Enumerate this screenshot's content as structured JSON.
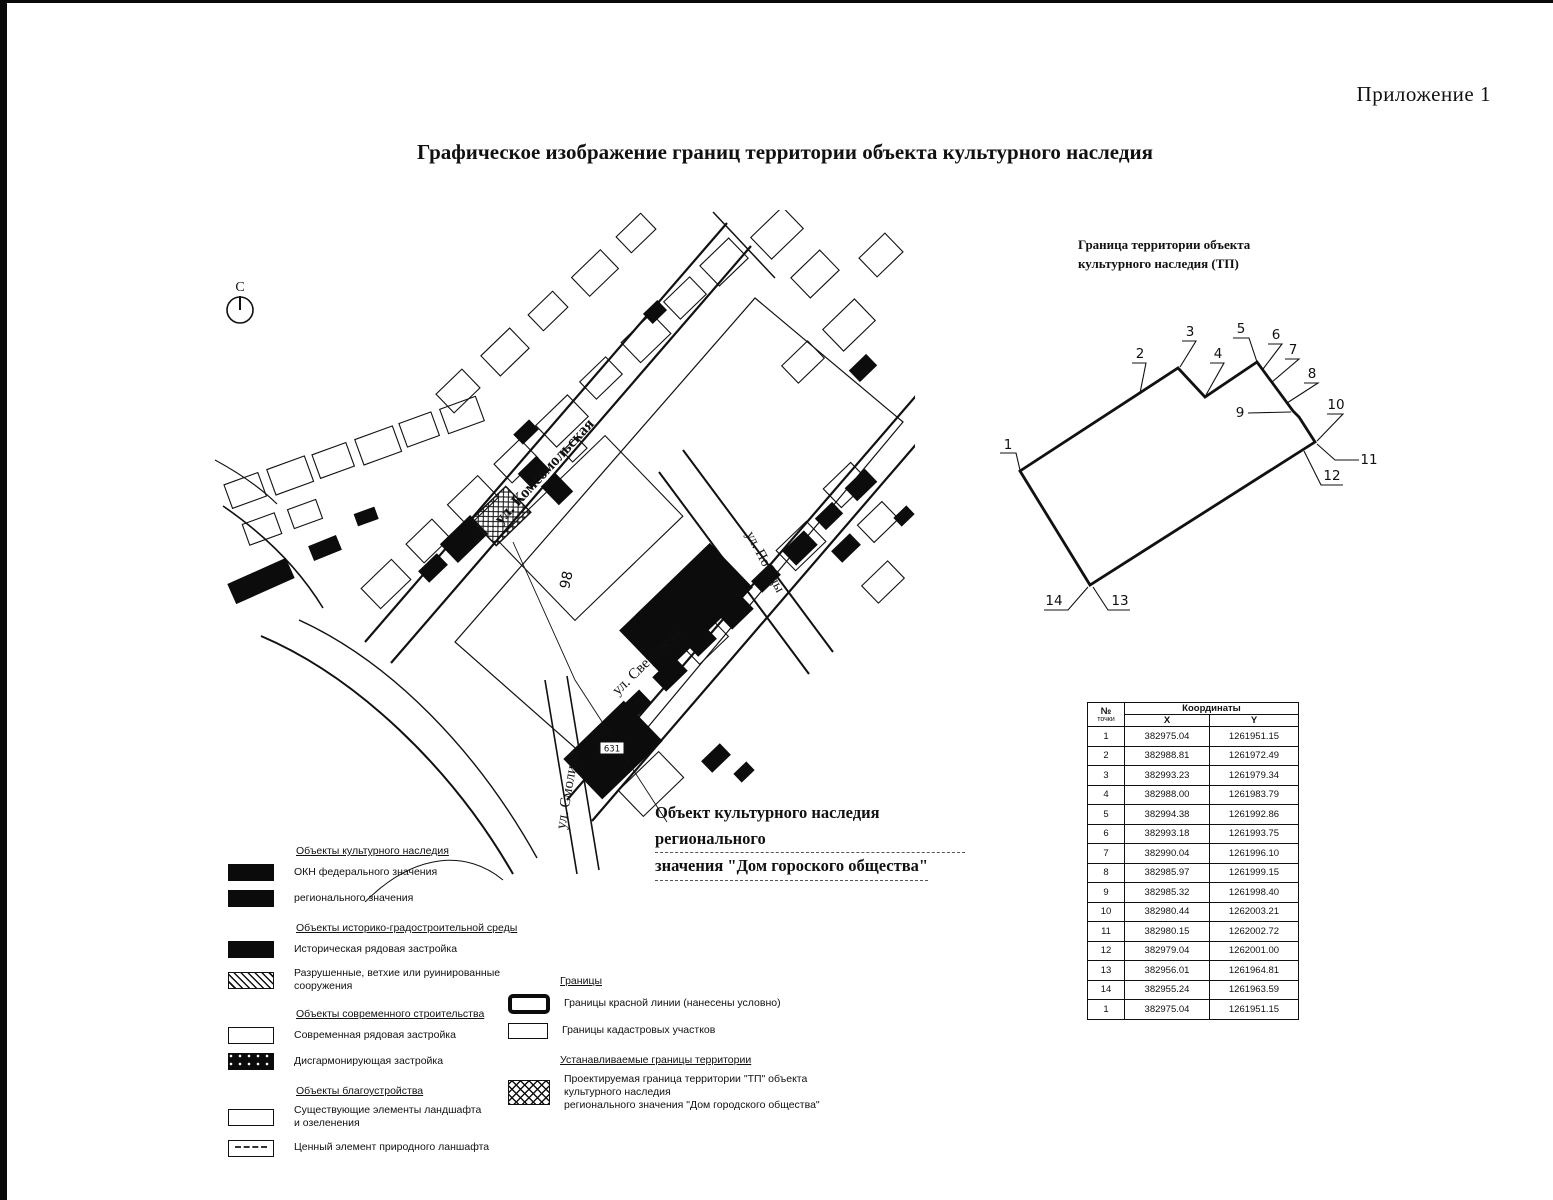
{
  "page": {
    "corner_label": "Приложение 1",
    "title": "Графическое изображение границ территории объекта культурного наследия"
  },
  "map": {
    "north_label": "С",
    "streets": {
      "komsomolskaya": "ул. Комсомольская",
      "sverdlova": "ул. Свердлова",
      "pobedy": "ул. Победы",
      "smolina": "ул. Смолина"
    },
    "building_labels": {
      "b98": "98",
      "b631": "631"
    },
    "annotation_line1": "Объект культурного наследия регионального",
    "annotation_line2": "значения \"Дом гороского общества\""
  },
  "boundary_diagram": {
    "title": "Граница территории объекта\nкультурного наследия (ТП)",
    "point_labels": [
      "1",
      "2",
      "3",
      "4",
      "5",
      "6",
      "7",
      "8",
      "9",
      "10",
      "11",
      "12",
      "13",
      "14"
    ]
  },
  "coords_table": {
    "col_point_no": "№",
    "col_point_sub": "точки",
    "col_coords": "Координаты",
    "col_x": "X",
    "col_y": "Y",
    "rows": [
      [
        "1",
        "382975.04",
        "1261951.15"
      ],
      [
        "2",
        "382988.81",
        "1261972.49"
      ],
      [
        "3",
        "382993.23",
        "1261979.34"
      ],
      [
        "4",
        "382988.00",
        "1261983.79"
      ],
      [
        "5",
        "382994.38",
        "1261992.86"
      ],
      [
        "6",
        "382993.18",
        "1261993.75"
      ],
      [
        "7",
        "382990.04",
        "1261996.10"
      ],
      [
        "8",
        "382985.97",
        "1261999.15"
      ],
      [
        "9",
        "382985.32",
        "1261998.40"
      ],
      [
        "10",
        "382980.44",
        "1262003.21"
      ],
      [
        "11",
        "382980.15",
        "1262002.72"
      ],
      [
        "12",
        "382979.04",
        "1262001.00"
      ],
      [
        "13",
        "382956.01",
        "1261964.81"
      ],
      [
        "14",
        "382955.24",
        "1261963.59"
      ],
      [
        "1",
        "382975.04",
        "1261951.15"
      ]
    ]
  },
  "legend": {
    "left": [
      {
        "header": "Объекты культурного наследия",
        "items": [
          {
            "label": "ОКН федерального значения"
          },
          {
            "label": "регионального значения"
          }
        ]
      },
      {
        "header": "Объекты историко-градостроительной среды",
        "items": [
          {
            "label": "Историческая рядовая застройка"
          },
          {
            "label": "Разрушенные, ветхие или руинированные сооружения"
          }
        ]
      },
      {
        "header": "Объекты современного строительства",
        "items": [
          {
            "label": "Современная рядовая застройка"
          },
          {
            "label": "Дисгармонирующая застройка"
          }
        ]
      },
      {
        "header": "Объекты благоустройства",
        "items": [
          {
            "label": "Существующие элементы ландшафта\nи озеленения"
          },
          {
            "label": "Ценный элемент природного ланшафта"
          }
        ]
      }
    ],
    "right": [
      {
        "header": "Границы",
        "items": [
          {
            "label": "Границы красной линии (нанесены условно)"
          },
          {
            "label": "Границы кадастровых участков"
          }
        ]
      },
      {
        "header": "Устанавливаемые границы территории",
        "items": [
          {
            "label": "Проектируемая граница территории \"ТП\" объекта культурного наследия\nрегионального значения \"Дом городского общества\""
          }
        ]
      }
    ]
  }
}
